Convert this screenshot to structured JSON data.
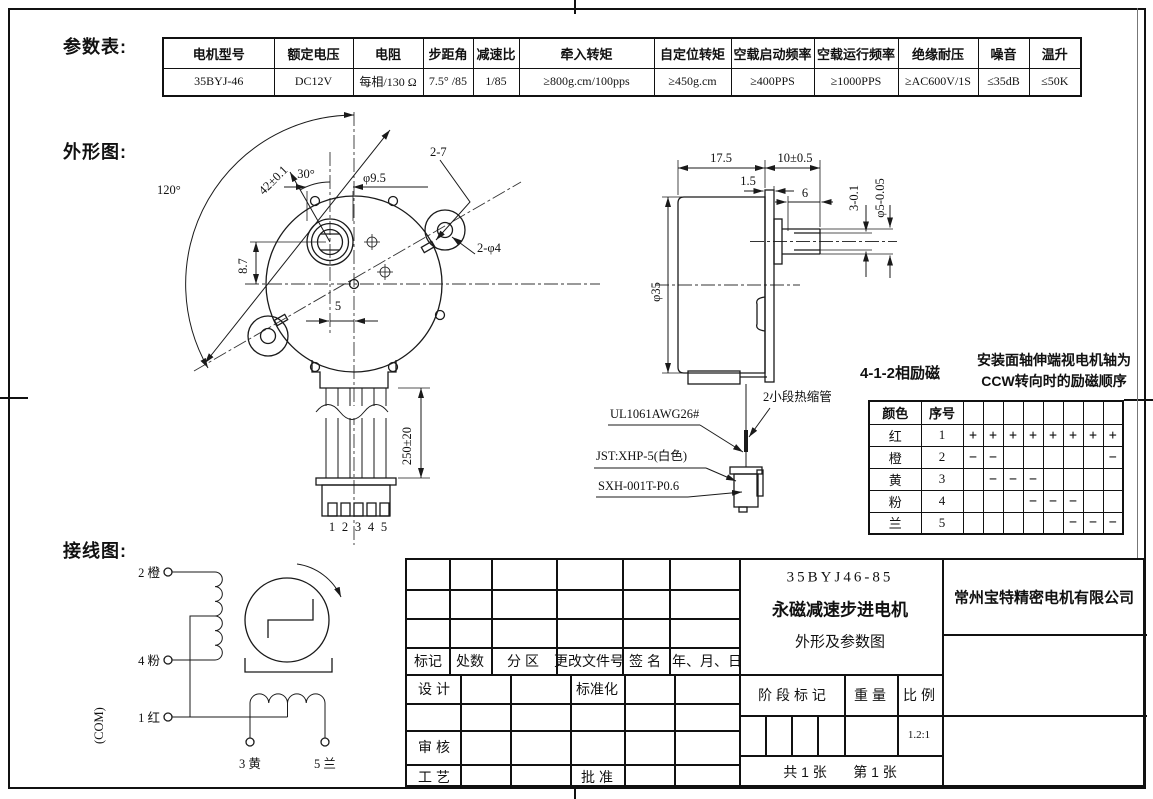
{
  "section_labels": {
    "param": "参数表:",
    "outline": "外形图:",
    "wiring": "接线图:"
  },
  "param_table": {
    "headers": [
      "电机型号",
      "额定电压",
      "电阻",
      "步距角",
      "减速比",
      "牵入转矩",
      "自定位转矩",
      "空载启动频率",
      "空载运行频率",
      "绝缘耐压",
      "噪音",
      "温升"
    ],
    "values": [
      "35BYJ-46",
      "DC12V",
      "每相/130 Ω",
      "7.5° /85",
      "1/85",
      "≥800g.cm/100pps",
      "≥450g.cm",
      "≥400PPS",
      "≥1000PPS",
      "≥AC600V/1S",
      "≤35dB",
      "≤50K"
    ]
  },
  "front_view": {
    "dim_angle_ears": "120°",
    "dim_hole_dist": "42±0.1",
    "dim_angle_30": "30°",
    "dim_boss_dia": "φ9.5",
    "dim_slots": "2-7",
    "dim_holes": "2-φ4",
    "dim_offset_v": "8.7",
    "dim_offset_h": "5",
    "dim_wire_len": "250±20",
    "pins": [
      "1",
      "2",
      "3",
      "4",
      "5"
    ]
  },
  "side_view": {
    "dim_body_len": "17.5",
    "dim_shaft_len": "10±0.5",
    "dim_plate": "1.5",
    "dim_flat_len": "6",
    "dim_flat": "3-0.1",
    "dim_shaft_dia": "φ5-0.05",
    "dim_body_dia": "φ35",
    "note_tube": "2小段热缩管",
    "note_wire": "UL1061AWG26#",
    "note_connector": "JST:XHP-5(白色)",
    "note_terminal": "SXH-001T-P0.6"
  },
  "excitation": {
    "mode": "4-1-2相励磁",
    "note_line1": "安装面轴伸端视电机轴为",
    "note_line2": "CCW转向时的励磁顺序",
    "col_color": "颜色",
    "col_no": "序号",
    "rows": [
      {
        "color": "红",
        "no": "1",
        "steps": [
          "+",
          "+",
          "+",
          "+",
          "+",
          "+",
          "+",
          "+"
        ]
      },
      {
        "color": "橙",
        "no": "2",
        "steps": [
          "−",
          "−",
          "",
          "",
          "",
          "",
          "",
          "−"
        ]
      },
      {
        "color": "黄",
        "no": "3",
        "steps": [
          "",
          "−",
          "−",
          "−",
          "",
          "",
          "",
          ""
        ]
      },
      {
        "color": "粉",
        "no": "4",
        "steps": [
          "",
          "",
          "",
          "−",
          "−",
          "−",
          "",
          ""
        ]
      },
      {
        "color": "兰",
        "no": "5",
        "steps": [
          "",
          "",
          "",
          "",
          "",
          "−",
          "−",
          "−"
        ]
      }
    ]
  },
  "wiring_diagram": {
    "terminal_2": "2 橙",
    "terminal_4": "4 粉",
    "terminal_1": "1 红",
    "common": "(COM)",
    "terminal_3": "3 黄",
    "terminal_5": "5 兰"
  },
  "title_block": {
    "product_code": "35BYJ46-85",
    "product_name": "永磁减速步进电机",
    "drawing_title": "外形及参数图",
    "company": "常州宝特精密电机有限公司",
    "rev_headers": [
      "标记",
      "处数",
      "分 区",
      "更改文件号",
      "签 名",
      "年、月、日"
    ],
    "role_design": "设 计",
    "role_standard": "标准化",
    "role_review": "审 核",
    "role_process": "工 艺",
    "role_approve": "批 准",
    "stage_label": "阶 段 标 记",
    "weight_label": "重 量",
    "scale_label": "比 例",
    "scale_value": "1.2:1",
    "sheet_total": "共 1 张",
    "sheet_number": "第 1 张"
  }
}
